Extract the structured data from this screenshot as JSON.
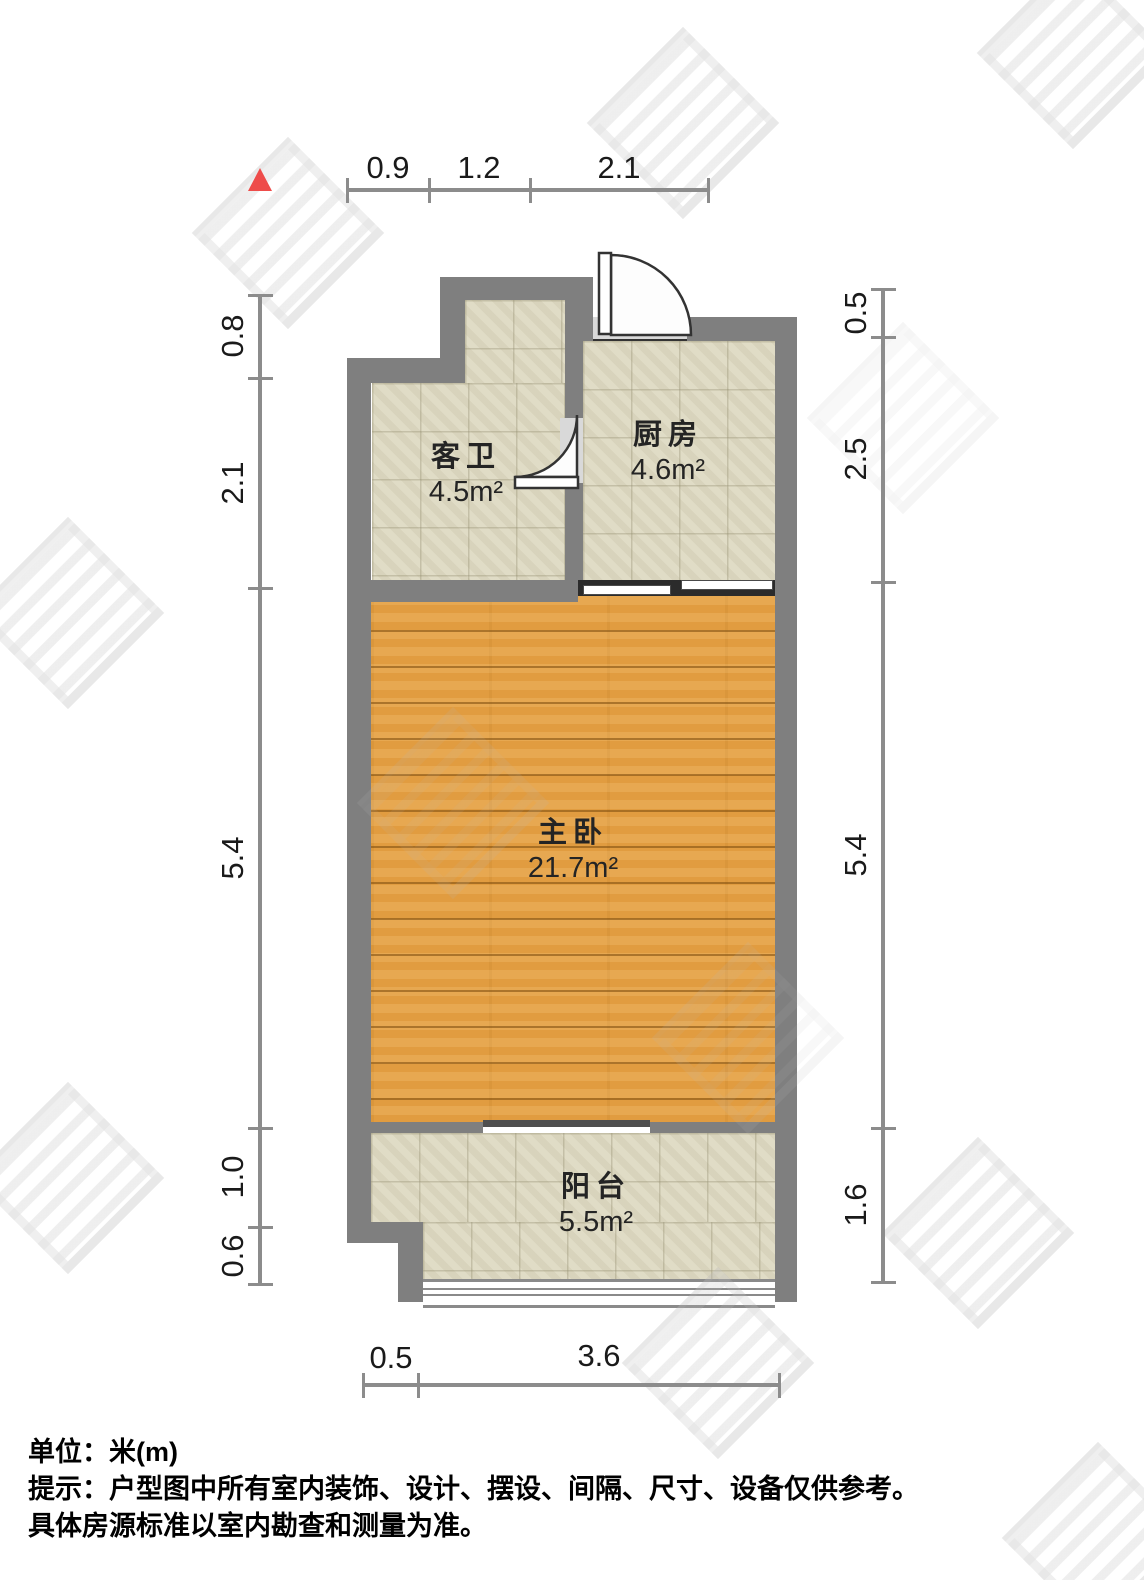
{
  "plan": {
    "north_marker": "north-arrow",
    "rooms": [
      {
        "id": "bathroom",
        "name": "客卫",
        "area": "4.5m²"
      },
      {
        "id": "kitchen",
        "name": "厨房",
        "area": "4.6m²"
      },
      {
        "id": "bedroom",
        "name": "主卧",
        "area": "21.7m²"
      },
      {
        "id": "balcony",
        "name": "阳台",
        "area": "5.5m²"
      }
    ],
    "dimensions": {
      "top": [
        "0.9",
        "1.2",
        "2.1"
      ],
      "left": [
        "0.8",
        "2.1",
        "5.4",
        "1.0",
        "0.6"
      ],
      "right": [
        "0.5",
        "2.5",
        "5.4",
        "1.6"
      ],
      "bottom": [
        "0.5",
        "3.6"
      ]
    }
  },
  "footer": {
    "unit": "单位：米(m)",
    "note1": "提示：户型图中所有室内装饰、设计、摆设、间隔、尺寸、设备仅供参考。",
    "note2": "具体房源标准以室内勘查和测量为准。"
  },
  "colors": {
    "wall": "#7f7f7f",
    "tile": "#ded9c2",
    "wood": "#e19c40",
    "threshold": "#d9d9d9",
    "north": "#ee4c4a",
    "dim": "#8c8c8c"
  }
}
